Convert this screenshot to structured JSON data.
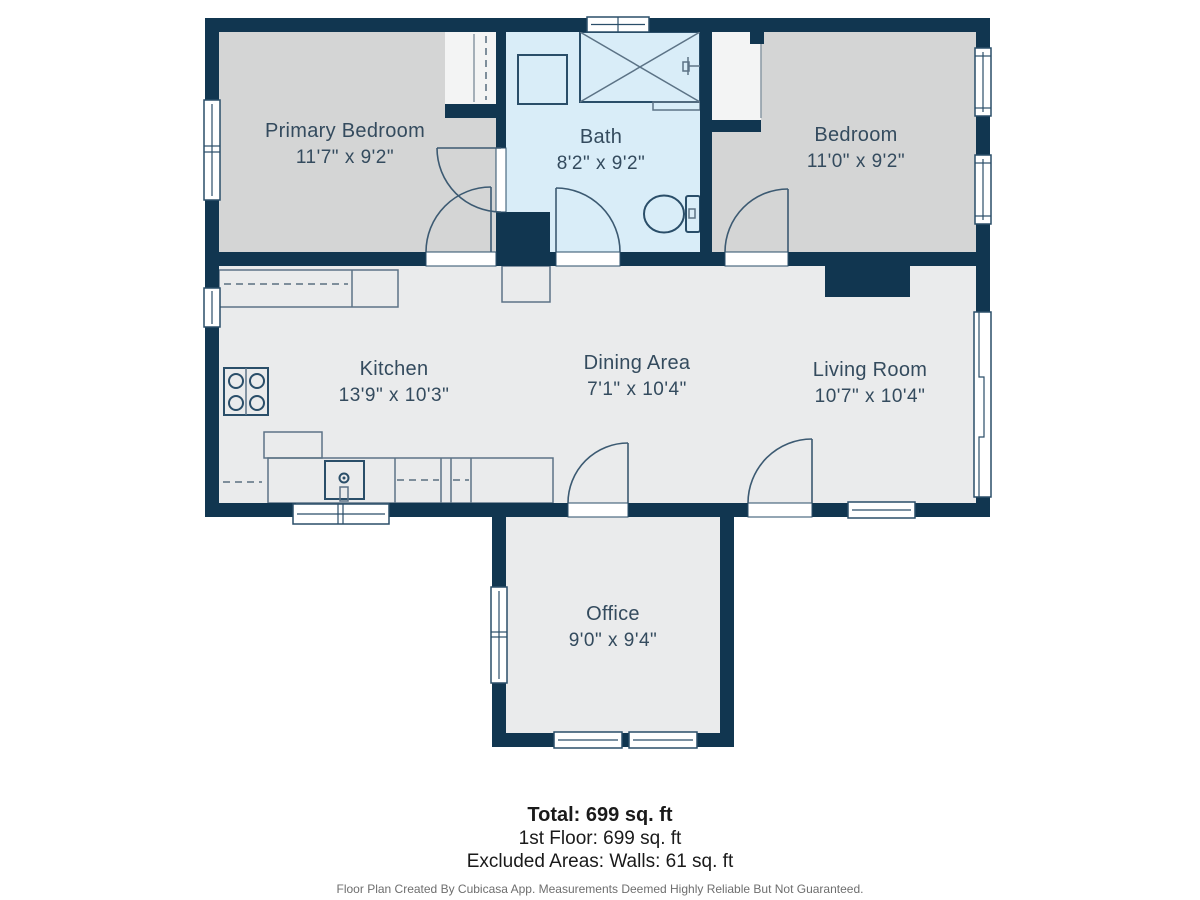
{
  "floorplan": {
    "rooms": [
      {
        "name": "Primary Bedroom",
        "dims": "11'7\" x 9'2\""
      },
      {
        "name": "Bath",
        "dims": "8'2\" x 9'2\""
      },
      {
        "name": "Bedroom",
        "dims": "11'0\" x 9'2\""
      },
      {
        "name": "Kitchen",
        "dims": "13'9\" x 10'3\""
      },
      {
        "name": "Dining Area",
        "dims": "7'1\" x 10'4\""
      },
      {
        "name": "Living Room",
        "dims": "10'7\" x 10'4\""
      },
      {
        "name": "Office",
        "dims": "9'0\" x 9'4\""
      }
    ],
    "summary": {
      "total": "Total: 699 sq. ft",
      "first_floor": "1st Floor: 699 sq. ft",
      "excluded": "Excluded Areas: Walls: 61 sq. ft"
    },
    "disclaimer": "Floor Plan Created By Cubicasa App. Measurements Deemed Highly Reliable But Not Guaranteed.",
    "colors": {
      "wall": "#113650",
      "bath_floor": "#d9edf8",
      "bedroom_floor": "#d4d5d5",
      "main_floor": "#eaebec",
      "closet_floor": "#f3f4f4",
      "fixture_line": "#2a4e69",
      "label_text": "#344b5e",
      "disclaimer_text": "#6e6e6e"
    }
  }
}
